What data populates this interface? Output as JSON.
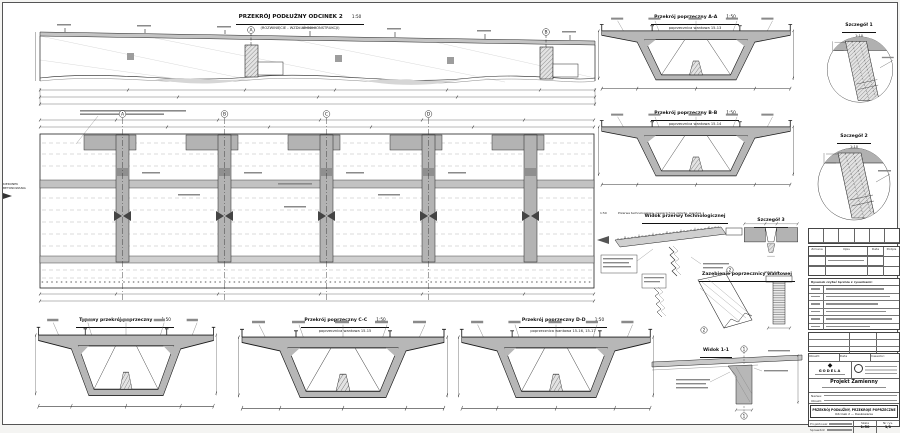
{
  "long_section": {
    "title": "PRZEKRÓJ PODŁUŻNY ODCINEK 2",
    "scale": "1:50",
    "subtitle": "(ROZWINIĘCIE - WZDŁUŻ OSI KONSTRUKCJI)"
  },
  "plan": {
    "direction_line1": "KIERUNEK",
    "direction_line2": "BETONOWANIA"
  },
  "sections": [
    {
      "title": "Przekrój poprzeczny A-A",
      "scale": "1:50",
      "subtitle": "poprzecznica wantowa 15-13"
    },
    {
      "title": "Przekrój poprzeczny B-B",
      "scale": "1:50",
      "subtitle": "poprzecznica wantowa 15-14"
    },
    {
      "title": "Typowy przekrój poprzeczny",
      "scale": "1:50",
      "subtitle": ""
    },
    {
      "title": "Przekrój poprzeczny C-C",
      "scale": "1:50",
      "subtitle": "poprzecznica wantowa 15-15"
    },
    {
      "title": "Przekrój poprzeczny D-D",
      "scale": "1:50",
      "subtitle": "poprzecznica wantowa 15-16, 15-17"
    }
  ],
  "details": [
    {
      "title": "Szczegół 1",
      "scale": "1:10"
    },
    {
      "title": "Szczegół 2",
      "scale": "1:10"
    },
    {
      "title": "Szczegół 3",
      "scale": "1:10"
    }
  ],
  "views": {
    "tech_break_title": "Widok przerwy technologicznej",
    "tech_break_scale": "1:50",
    "tech_break_note": "Przerwa technologiczna, powierzchnia zatarta, warstwa 1",
    "interlock_title": "Zazębienie poprzecznicy wantowej",
    "interlock_view2": "widok 2-2",
    "view11_title": "Widok 1-1"
  },
  "markers": {
    "a": "A",
    "b": "B",
    "c": "C",
    "d": "D",
    "n1": "1",
    "n2": "2"
  },
  "titleblock": {
    "company": "GODELA",
    "project": "Projekt Zamienny",
    "notes_header": "Rysunek czytać łącznie z rysunkami:",
    "rev_headers": [
      "Zmiana",
      "Opis",
      "Data",
      "Podpis"
    ],
    "labels": {
      "investor": "Inwestor:",
      "name": "Nazwa:",
      "object": "Obiekt:",
      "designed": "Projektował",
      "checked": "Sprawdził",
      "scale": "Skala",
      "drawing_no": "Nr rys.",
      "date": "Data"
    },
    "drawing_title_1": "PRZEKRÓJ PODŁUŻNY, PRZEKROJE POPRZECZNE",
    "drawing_title_2": "Odcinek 2 — Deskowanie",
    "scale_value": "1:50",
    "sheet": "1/1"
  }
}
